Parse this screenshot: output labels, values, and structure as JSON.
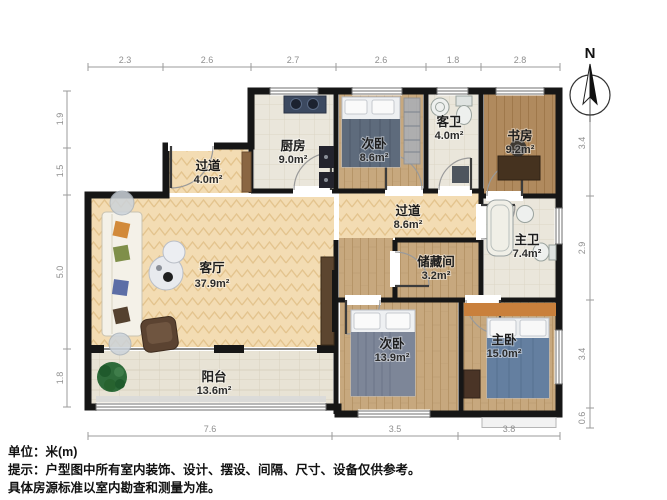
{
  "floor_plan": {
    "rooms": {
      "entry_hall": {
        "name": "过道",
        "area": "4.0m²"
      },
      "kitchen": {
        "name": "厨房",
        "area": "9.0m²"
      },
      "bedroom_top": {
        "name": "次卧",
        "area": "8.6m²"
      },
      "guest_bath": {
        "name": "客卫",
        "area": "4.0m²"
      },
      "study": {
        "name": "书房",
        "area": "9.2m²"
      },
      "hallway": {
        "name": "过道",
        "area": "8.6m²"
      },
      "master_bath": {
        "name": "主卫",
        "area": "7.4m²"
      },
      "living_room": {
        "name": "客厅",
        "area": "37.9m²"
      },
      "storage": {
        "name": "储藏间",
        "area": "3.2m²"
      },
      "bedroom_bottom": {
        "name": "次卧",
        "area": "13.9m²"
      },
      "master_bedroom": {
        "name": "主卧",
        "area": "15.0m²"
      },
      "balcony": {
        "name": "阳台",
        "area": "13.6m²"
      }
    },
    "dimensions": {
      "top": [
        "2.3",
        "2.6",
        "2.7",
        "2.6",
        "1.8",
        "2.8"
      ],
      "left": [
        "1.9",
        "1.5",
        "5.0",
        "1.8"
      ],
      "right": [
        "3.4",
        "2.9",
        "3.4",
        "0.6"
      ],
      "bottom": [
        "7.6",
        "3.5",
        "3.8"
      ]
    },
    "compass": {
      "north": "N"
    }
  },
  "footer": {
    "unit": "单位：米(m)",
    "note1": "提示：户型图中所有室内装饰、设计、摆设、间隔、尺寸、设备仅供参考。",
    "note2": "具体房源标准以室内勘查和测量为准。"
  }
}
